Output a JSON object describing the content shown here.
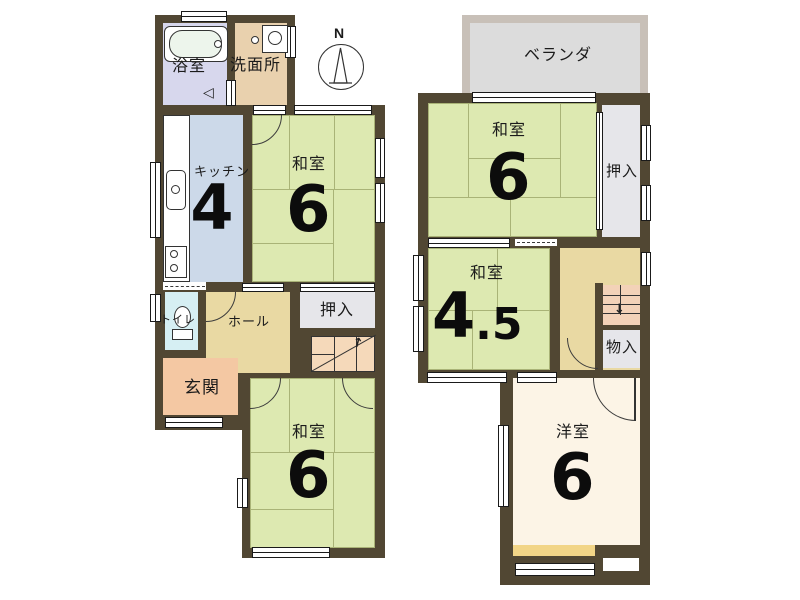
{
  "icons": {
    "north": "N",
    "up_arrow": "↑",
    "down_arrow": "↓",
    "fold_door": "◁"
  },
  "colors": {
    "wall": "#514733",
    "tatami": "#dde9b1",
    "tatami_line": "#a9b377",
    "kitchen": "#ccd9e9",
    "bath": "#d7d7ed",
    "washroom": "#e9d1ae",
    "toilet": "#d6eff3",
    "hall": "#e9d9a3",
    "genkan": "#f4c8a3",
    "closet": "#e6e6ea",
    "stairs": "#f5d9ba",
    "western_room": "#fcf4e6",
    "veranda": "#dcdcdc",
    "veranda_border": "#c8c0b8",
    "sill_yellow": "#f2d587"
  },
  "floor1": {
    "rooms": {
      "bath": {
        "label": "浴室"
      },
      "washroom": {
        "label": "洗面所"
      },
      "kitchen": {
        "label": "キッチン",
        "size": "4"
      },
      "washitsu_upper": {
        "label": "和室",
        "size": "6"
      },
      "oshiire": {
        "label": "押入"
      },
      "hall": {
        "label": "ホール"
      },
      "toilet": {
        "label": "トイレ"
      },
      "genkan": {
        "label": "玄関"
      },
      "washitsu_lower": {
        "label": "和室",
        "size": "6"
      }
    }
  },
  "floor2": {
    "rooms": {
      "veranda": {
        "label": "ベランダ"
      },
      "washitsu": {
        "label": "和室",
        "size": "6"
      },
      "oshiire": {
        "label": "押入"
      },
      "washitsu_small": {
        "label": "和室",
        "size_big": "4",
        "size_small": ".5"
      },
      "monoire": {
        "label": "物入"
      },
      "youshitsu": {
        "label": "洋室",
        "size": "6"
      }
    }
  }
}
